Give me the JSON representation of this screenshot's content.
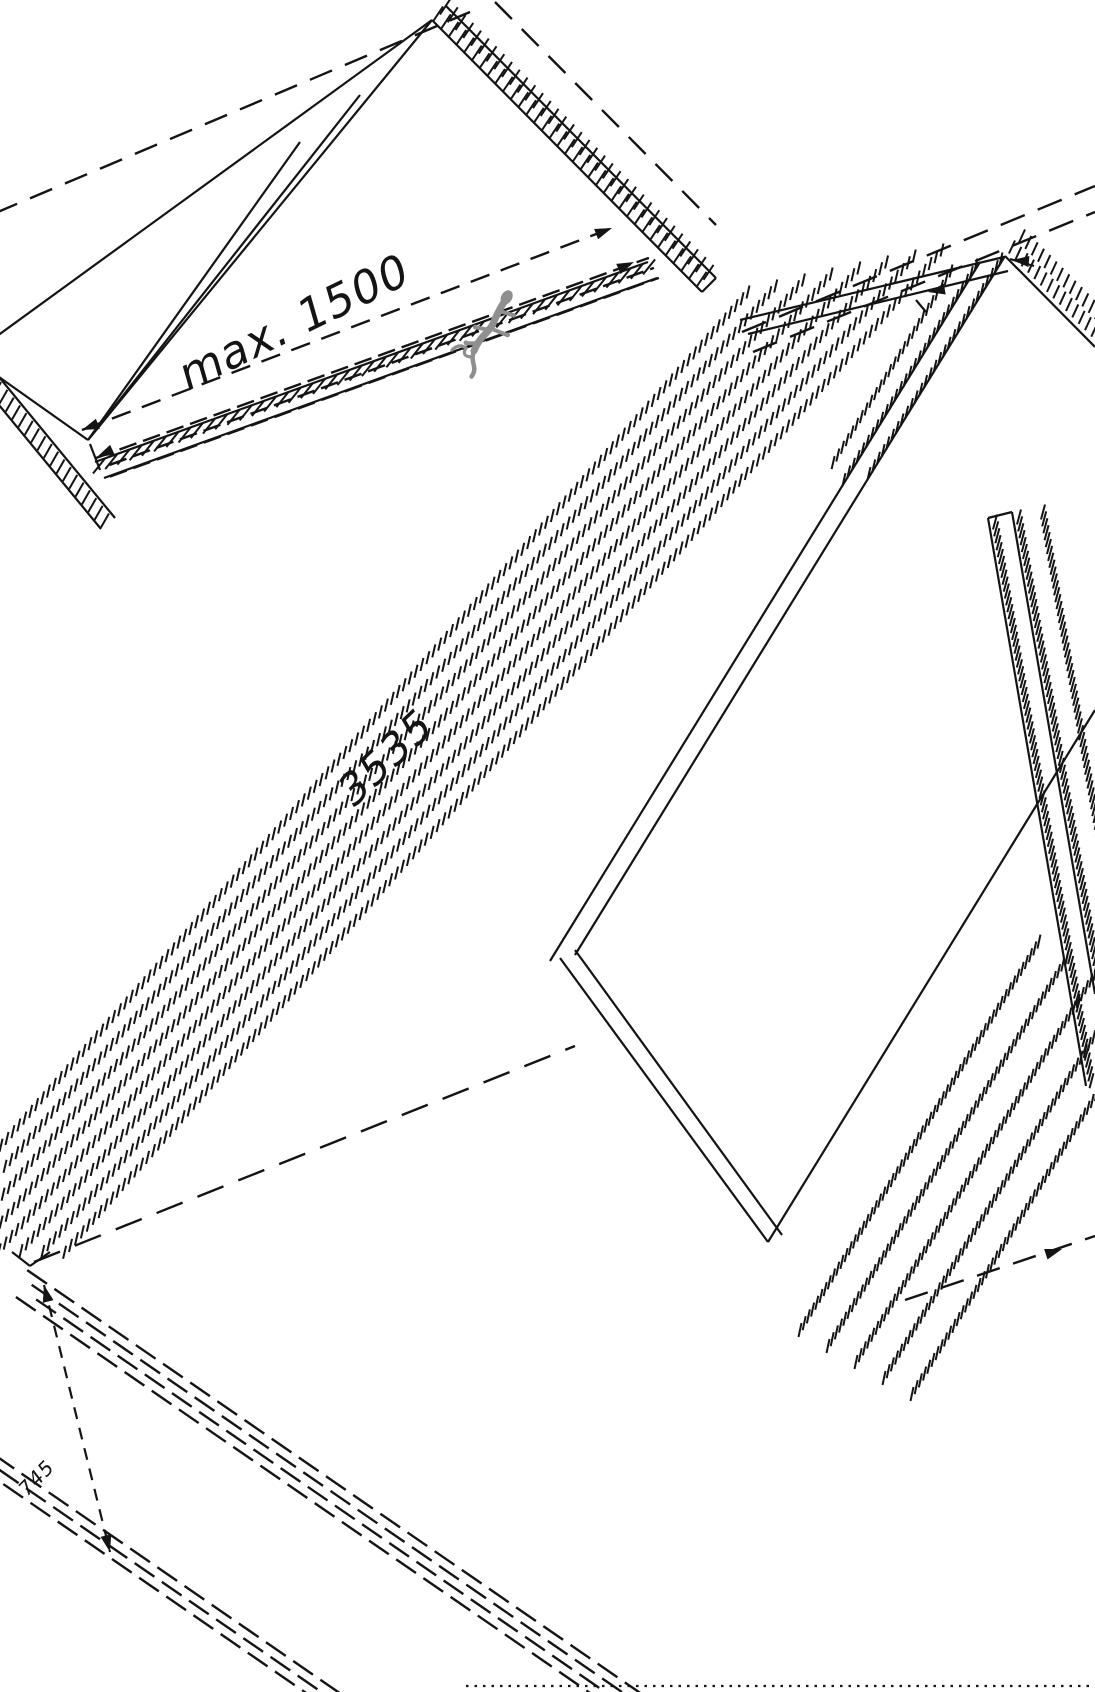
{
  "diagram": {
    "kind": "isometric-technical-drawing",
    "description": "CAD style installation drawing of awning / panel assembly with hatched edges and dimension lines",
    "background_color": "#ffffff",
    "line_color": "#141414",
    "watermark_color": "#8f8f8f",
    "annotations": {
      "max_span": {
        "text": "max. 1500"
      },
      "panel_length": {
        "text": "3535"
      },
      "edge_offset": {
        "text": "745"
      }
    },
    "watermark": {
      "icon": "gecko-logo-icon"
    }
  }
}
